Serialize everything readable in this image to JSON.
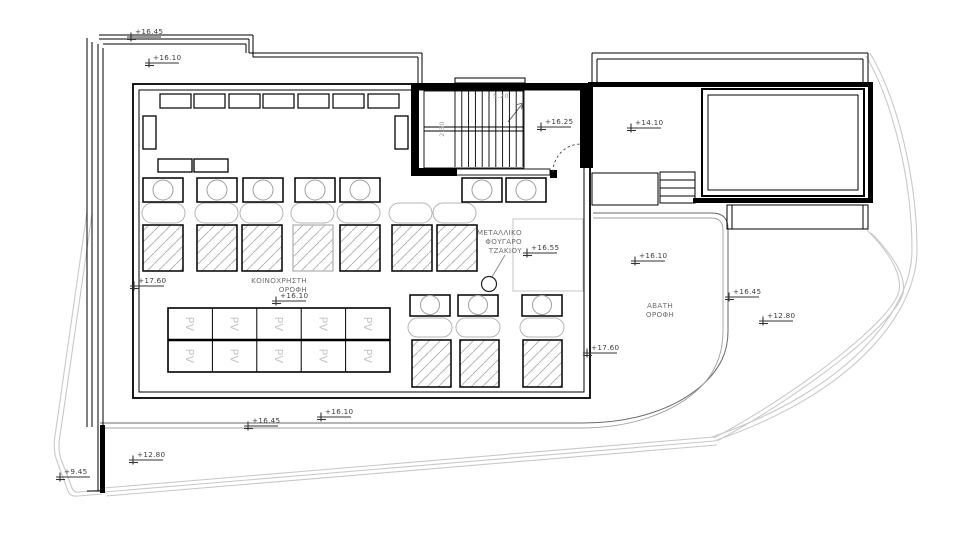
{
  "page": {
    "background": "#ffffff",
    "type": "architectural-roof-plan"
  },
  "labels": {
    "common_roof": {
      "lines": [
        "ΚΟΙΝΟΧΡΗΣΤΗ",
        "ΟΡΟΦΗ"
      ]
    },
    "chimney": {
      "lines": [
        "ΜΕΤΑΛΛΙΚΟ",
        "ΦΟΥΓΑΡΟ",
        "ΤΖΑΚΙΟΥ"
      ]
    },
    "inaccessible_roof": {
      "lines": [
        "ΑΒΑΤΗ",
        "ΟΡΟΦΗ"
      ]
    },
    "pv_panel": "PV",
    "stair_width": "5.20",
    "stair_depth": "2.50"
  },
  "colors": {
    "ink": "#000000",
    "marker_text": "#3d3d3d",
    "label_gray": "#6f6f6f",
    "dim_gray": "#9c9c9c",
    "light_line": "#c9c9c9",
    "pill_gray": "#b5b5b5",
    "hatch_gray": "#b6b6b6",
    "pv_gray": "#c6c6c6"
  },
  "elevation_markers": [
    {
      "id": "elev-top-left-upper",
      "label": "+16.45",
      "x": 131,
      "y": 37
    },
    {
      "id": "elev-top-left-lower",
      "label": "+16.10",
      "x": 149,
      "y": 63
    },
    {
      "id": "elev-stair-landing",
      "label": "+16.25",
      "x": 541,
      "y": 127
    },
    {
      "id": "elev-terrace",
      "label": "+14.10",
      "x": 631,
      "y": 128
    },
    {
      "id": "elev-chimney-plat",
      "label": "+16.55",
      "x": 527,
      "y": 253
    },
    {
      "id": "elev-avati-roof",
      "label": "+16.10",
      "x": 635,
      "y": 261
    },
    {
      "id": "elev-right-edge",
      "label": "+16.45",
      "x": 729,
      "y": 297
    },
    {
      "id": "elev-right-low",
      "label": "+12.80",
      "x": 763,
      "y": 321
    },
    {
      "id": "elev-left-parapet",
      "label": "+17.60",
      "x": 134,
      "y": 286
    },
    {
      "id": "elev-right-parapet",
      "label": "+17.60",
      "x": 587,
      "y": 353
    },
    {
      "id": "elev-common-roof",
      "label": "+16.10",
      "x": 276,
      "y": 301
    },
    {
      "id": "elev-bottom-mid",
      "label": "+16.10",
      "x": 321,
      "y": 417
    },
    {
      "id": "elev-bottom-left",
      "label": "+16.45",
      "x": 248,
      "y": 426
    },
    {
      "id": "elev-low-roof",
      "label": "+12.80",
      "x": 133,
      "y": 460
    },
    {
      "id": "elev-ground",
      "label": "+9.45",
      "x": 60,
      "y": 477
    }
  ],
  "drawing": {
    "canvas": {
      "w": 980,
      "h": 543
    },
    "site_paths": [
      {
        "n": "site-boundary-left-a",
        "d": "M 87 212 L 56 429 Q 52 449 57 461 L 68 491 Q 70 497 78 496 L 102 494"
      },
      {
        "n": "site-boundary-left-b",
        "d": "M 92 214 L 61 429 Q 57 448 61 459 L 72 488 Q 74 493 80 492 L 102 490"
      },
      {
        "n": "site-boundary-right-a",
        "d": "M 870 53 C 898 100 917 180 917 250 C 917 310 858 392 714 441"
      },
      {
        "n": "site-boundary-right-b",
        "d": "M 866 56 C 893 102 912 181 912 250 C 912 307 854 388 712 437"
      },
      {
        "n": "site-diagonal-a",
        "d": "M 867 230 C 892 255 902 276 899 291 C 893 320 800 392 714 438"
      },
      {
        "n": "site-diagonal-b",
        "d": "M 871 233 C 896 258 906 278 903 293 C 897 322 803 395 717 441"
      },
      {
        "n": "site-bottom-a",
        "d": "M 714 437 L 104 488"
      },
      {
        "n": "site-bottom-b",
        "d": "M 714 441 L 104 492"
      },
      {
        "n": "site-bottom-c",
        "d": "M 717 445 L 106 496"
      }
    ],
    "roof_paths": [
      {
        "n": "lower-roof-edge-outer",
        "d": "M 100 423 H 583 C 635 423 675 408 700 387 C 722 368 728 350 728 331 V 229 Q 728 213 712 213 H 593",
        "s": "#6a6a6a",
        "w": 1
      },
      {
        "n": "lower-roof-edge-inner",
        "d": "M 100 428 H 581 C 631 428 670 413 694 393 C 716 375 723 353 723 331 V 230 Q 723 218 711 218 H 593",
        "s": "#a0a0a0",
        "w": 0.9
      }
    ],
    "misc_paths": [
      {
        "n": "stair-door-swing",
        "d": "M 553 172 A 28 28 0 0 1 581 144",
        "s": "#444444",
        "w": 0.9,
        "dash": "2.5,2.5"
      },
      {
        "n": "stair-arrow-head",
        "d": "M 523 103 L 517 104.5 M 523 103 L 521.5 109",
        "s": "#555555",
        "w": 0.9
      }
    ],
    "lines": [
      {
        "n": "site-edge-left-1",
        "x1": 87,
        "y1": 38,
        "x2": 87,
        "y2": 427
      },
      {
        "n": "site-edge-left-2",
        "x1": 92,
        "y1": 42,
        "x2": 92,
        "y2": 427
      },
      {
        "n": "building-edge-left-1",
        "x1": 98,
        "y1": 44,
        "x2": 98,
        "y2": 491
      },
      {
        "n": "building-edge-left-2",
        "x1": 103,
        "y1": 48,
        "x2": 103,
        "y2": 491
      },
      {
        "n": "frame-a-top-1",
        "x1": 99,
        "y1": 35,
        "x2": 253,
        "y2": 35
      },
      {
        "n": "frame-a-top-2",
        "x1": 99,
        "y1": 39,
        "x2": 249,
        "y2": 39
      },
      {
        "n": "frame-a-right-1",
        "x1": 253,
        "y1": 35,
        "x2": 253,
        "y2": 57
      },
      {
        "n": "frame-a-right-2",
        "x1": 249,
        "y1": 39,
        "x2": 249,
        "y2": 53
      },
      {
        "n": "frame-b-top",
        "x1": 103,
        "y1": 44,
        "x2": 246,
        "y2": 44
      },
      {
        "n": "frame-b-right",
        "x1": 246,
        "y1": 44,
        "x2": 246,
        "y2": 53
      },
      {
        "n": "band-top-1",
        "x1": 249,
        "y1": 53,
        "x2": 422,
        "y2": 53
      },
      {
        "n": "band-top-2",
        "x1": 253,
        "y1": 57,
        "x2": 418,
        "y2": 57
      },
      {
        "n": "band-right-1",
        "x1": 422,
        "y1": 53,
        "x2": 422,
        "y2": 84
      },
      {
        "n": "band-right-2",
        "x1": 418,
        "y1": 57,
        "x2": 418,
        "y2": 84
      },
      {
        "n": "terr-outline-top-1",
        "x1": 592,
        "y1": 53,
        "x2": 868,
        "y2": 53
      },
      {
        "n": "terr-outline-top-2",
        "x1": 597,
        "y1": 59,
        "x2": 863,
        "y2": 59
      },
      {
        "n": "terr-outline-left-1",
        "x1": 592,
        "y1": 53,
        "x2": 592,
        "y2": 82
      },
      {
        "n": "terr-outline-left-2",
        "x1": 597,
        "y1": 59,
        "x2": 597,
        "y2": 82
      },
      {
        "n": "terr-outline-right-1",
        "x1": 868,
        "y1": 53,
        "x2": 868,
        "y2": 82
      },
      {
        "n": "terr-outline-right-2",
        "x1": 863,
        "y1": 59,
        "x2": 863,
        "y2": 82
      },
      {
        "n": "ext-stair-step-1",
        "x1": 660,
        "y1": 180,
        "x2": 695,
        "y2": 180
      },
      {
        "n": "ext-stair-step-2",
        "x1": 660,
        "y1": 188,
        "x2": 695,
        "y2": 188
      },
      {
        "n": "ext-stair-step-3",
        "x1": 660,
        "y1": 196,
        "x2": 695,
        "y2": 196
      },
      {
        "n": "strip-inner-left",
        "x1": 732,
        "y1": 205,
        "x2": 732,
        "y2": 229
      },
      {
        "n": "strip-inner-right",
        "x1": 863,
        "y1": 205,
        "x2": 863,
        "y2": 229
      },
      {
        "n": "flight-divider-1",
        "x1": 424,
        "y1": 127,
        "x2": 524,
        "y2": 127
      },
      {
        "n": "flight-divider-2",
        "x1": 424,
        "y1": 131,
        "x2": 524,
        "y2": 131
      },
      {
        "n": "stair-arrow",
        "x1": 508,
        "y1": 122,
        "x2": 523,
        "y2": 103,
        "s": "#555555",
        "w": 0.9
      },
      {
        "n": "chimney-leader",
        "x1": 505,
        "y1": 255,
        "x2": 492,
        "y2": 277,
        "s": "#8a8a8a",
        "w": 0.9
      },
      {
        "n": "building-bottom-cap",
        "x1": 87,
        "y1": 491,
        "x2": 103,
        "y2": 491
      }
    ],
    "rects": [
      {
        "n": "main-roof-outer",
        "x": 133,
        "y": 84,
        "w": 457,
        "h": 314,
        "sw": 1.8
      },
      {
        "n": "main-roof-inner",
        "x": 139,
        "y": 90,
        "w": 445,
        "h": 302,
        "sw": 1
      },
      {
        "n": "stairwell-top-wall",
        "x": 411,
        "y": 83,
        "w": 182,
        "h": 7,
        "f": "#000"
      },
      {
        "n": "stairwell-left-wall",
        "x": 411,
        "y": 83,
        "w": 8,
        "h": 93,
        "f": "#000"
      },
      {
        "n": "stairwell-right-wall",
        "x": 580,
        "y": 83,
        "w": 13,
        "h": 85,
        "f": "#000"
      },
      {
        "n": "stairwell-bottom-wall",
        "x": 411,
        "y": 168,
        "w": 46,
        "h": 8,
        "f": "#000"
      },
      {
        "n": "door-jamb-block",
        "x": 550,
        "y": 170,
        "w": 7,
        "h": 8,
        "f": "#000"
      },
      {
        "n": "stair-landing-edge",
        "x": 455,
        "y": 169,
        "w": 95,
        "h": 6,
        "sw": 0.9
      },
      {
        "n": "stair-box",
        "x": 424,
        "y": 91,
        "w": 100,
        "h": 77,
        "sw": 0.9
      },
      {
        "n": "stair-roof-rect",
        "x": 455,
        "y": 78,
        "w": 70,
        "h": 5,
        "sw": 1
      },
      {
        "n": "terrace-top-wall",
        "x": 588,
        "y": 82,
        "w": 285,
        "h": 5,
        "f": "#000"
      },
      {
        "n": "terrace-right-wall",
        "x": 868,
        "y": 82,
        "w": 5,
        "h": 121,
        "f": "#000"
      },
      {
        "n": "terrace-bottom-wall",
        "x": 693,
        "y": 198,
        "w": 180,
        "h": 5,
        "f": "#000"
      },
      {
        "n": "skylight-outer",
        "x": 702,
        "y": 89,
        "w": 162,
        "h": 107,
        "sw": 2
      },
      {
        "n": "skylight-inner",
        "x": 708,
        "y": 95,
        "w": 150,
        "h": 95,
        "sw": 1
      },
      {
        "n": "landing-right",
        "x": 592,
        "y": 173,
        "w": 66,
        "h": 32,
        "sw": 1
      },
      {
        "n": "ext-stair-box",
        "x": 660,
        "y": 172,
        "w": 35,
        "h": 31,
        "sw": 1
      },
      {
        "n": "roof-strip-right",
        "x": 727,
        "y": 205,
        "w": 141,
        "h": 24,
        "sw": 1
      },
      {
        "n": "equip-left-vert",
        "x": 143,
        "y": 116,
        "w": 13,
        "h": 33,
        "sw": 1.3
      },
      {
        "n": "equip-right-vert",
        "x": 395,
        "y": 116,
        "w": 13,
        "h": 33,
        "sw": 1.3
      },
      {
        "n": "equip-small-1",
        "x": 158,
        "y": 159,
        "w": 34,
        "h": 13,
        "sw": 1.3
      },
      {
        "n": "equip-small-2",
        "x": 194,
        "y": 159,
        "w": 34,
        "h": 13,
        "sw": 1.3
      },
      {
        "n": "chimney-platform",
        "x": 513,
        "y": 219,
        "w": 70,
        "h": 72,
        "s": "#c5c5c5",
        "sw": 1
      },
      {
        "n": "parapet-bar-bottom-left",
        "x": 100,
        "y": 425,
        "w": 5,
        "h": 68,
        "f": "#000"
      }
    ],
    "rect_rows": [
      {
        "n": "vent-box",
        "xs": [
          160,
          194,
          229,
          263,
          298,
          333,
          368
        ],
        "y": 94,
        "w": 31,
        "h": 14,
        "sw": 1.2
      }
    ],
    "circle_rows": [
      {
        "n": "hvac-unit",
        "y": 178,
        "h": 24,
        "w": 40,
        "cy": 190,
        "r": 10,
        "xs": [
          143,
          197,
          243,
          295,
          340,
          462,
          506
        ]
      },
      {
        "n": "hvac-unit-lower",
        "y": 295,
        "h": 21,
        "w": 40,
        "cy": 305,
        "r": 9.5,
        "xs": [
          410,
          458,
          522
        ]
      }
    ],
    "pill_rows": [
      {
        "n": "duct-pill",
        "y": 203,
        "h": 20,
        "w": 43,
        "xs": [
          142,
          195,
          240,
          291,
          337,
          389,
          433
        ]
      },
      {
        "n": "duct-pill-lower",
        "y": 318,
        "h": 19,
        "w": 44,
        "xs": [
          408,
          456,
          520
        ]
      }
    ],
    "hatch_rows": [
      {
        "n": "skylight-panel",
        "y": 225,
        "h": 46,
        "w": 40,
        "xs": [
          143,
          197,
          242,
          293,
          340,
          392,
          437
        ],
        "grayIdx": 3
      },
      {
        "n": "skylight-panel-lower",
        "y": 340,
        "h": 47,
        "w": 39,
        "xs": [
          412,
          460,
          523
        ],
        "grayIdx": -1
      }
    ],
    "treads": {
      "x0": 455,
      "n": 11,
      "dx": 6.8,
      "y1": 91,
      "y2": 167
    },
    "chimney": {
      "cx": 489,
      "cy": 284,
      "r": 7.5
    },
    "pv": {
      "x": 168,
      "y": 308,
      "w": 222,
      "h": 64,
      "cols": 5,
      "rows": 2
    },
    "texts": [
      {
        "n": "label-common-roof",
        "bind": "labels.common_roof.lines",
        "x": 307,
        "y": 283,
        "lh": 9,
        "anchor": "end",
        "size": 7.2,
        "color": "#6f6f6f"
      },
      {
        "n": "label-chimney",
        "bind": "labels.chimney.lines",
        "x": 522,
        "y": 235,
        "lh": 9,
        "anchor": "end",
        "size": 7.2,
        "color": "#6f6f6f"
      },
      {
        "n": "label-inaccessible-roof",
        "bind": "labels.inaccessible_roof.lines",
        "x": 660,
        "y": 308,
        "lh": 9,
        "anchor": "middle",
        "size": 7.2,
        "color": "#6f6f6f"
      },
      {
        "n": "label-stair-width",
        "bind": "labels.stair_width",
        "x": 501,
        "y": 98,
        "anchor": "middle",
        "size": 6.5,
        "color": "#9c9c9c"
      },
      {
        "n": "label-stair-depth",
        "bind": "labels.stair_depth",
        "x": 444,
        "y": 129,
        "anchor": "middle",
        "size": 6.5,
        "color": "#9c9c9c",
        "rotate": -90
      }
    ]
  }
}
